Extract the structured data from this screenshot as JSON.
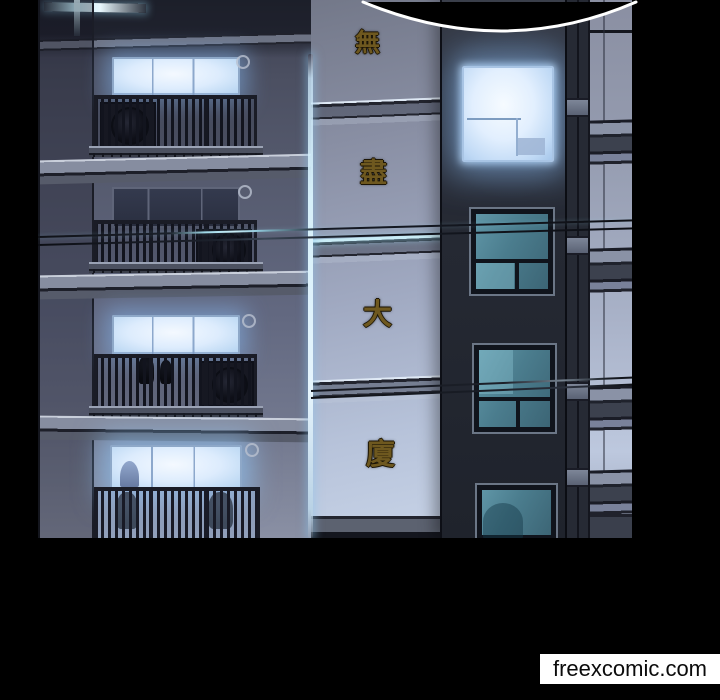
{
  "watermark": {
    "text": "freexcomic.com"
  },
  "sign": {
    "text": "無盡大廈",
    "orientation": "vertical",
    "chars": [
      "無",
      "盡",
      "大",
      "廈"
    ]
  },
  "speech_bubble": {
    "text": "",
    "note": "partial empty bubble, bottom arc only"
  },
  "scene": {
    "left_building_floors": [
      {
        "name": "floor-1",
        "window": "lit"
      },
      {
        "name": "floor-2",
        "window": "dark"
      },
      {
        "name": "floor-3",
        "window": "lit"
      },
      {
        "name": "floor-4",
        "window": "lit"
      }
    ],
    "right_tower_windows": [
      {
        "name": "window-1",
        "state": "glowing-white"
      },
      {
        "name": "window-2",
        "state": "teal"
      },
      {
        "name": "window-3",
        "state": "teal"
      },
      {
        "name": "window-4",
        "state": "teal-partial"
      }
    ]
  },
  "colors": {
    "page_bg": "#000000",
    "window_glow": "#ddecfd",
    "teal_glass": "#4b7d8e",
    "sign_gold": "#6e581f",
    "corner_light": "#d6f0fa",
    "wire_glint": "#c9ecf6",
    "bubble_stroke": "#ffffff",
    "watermark_bg": "#ffffff",
    "watermark_text": "#0b0b0b"
  }
}
